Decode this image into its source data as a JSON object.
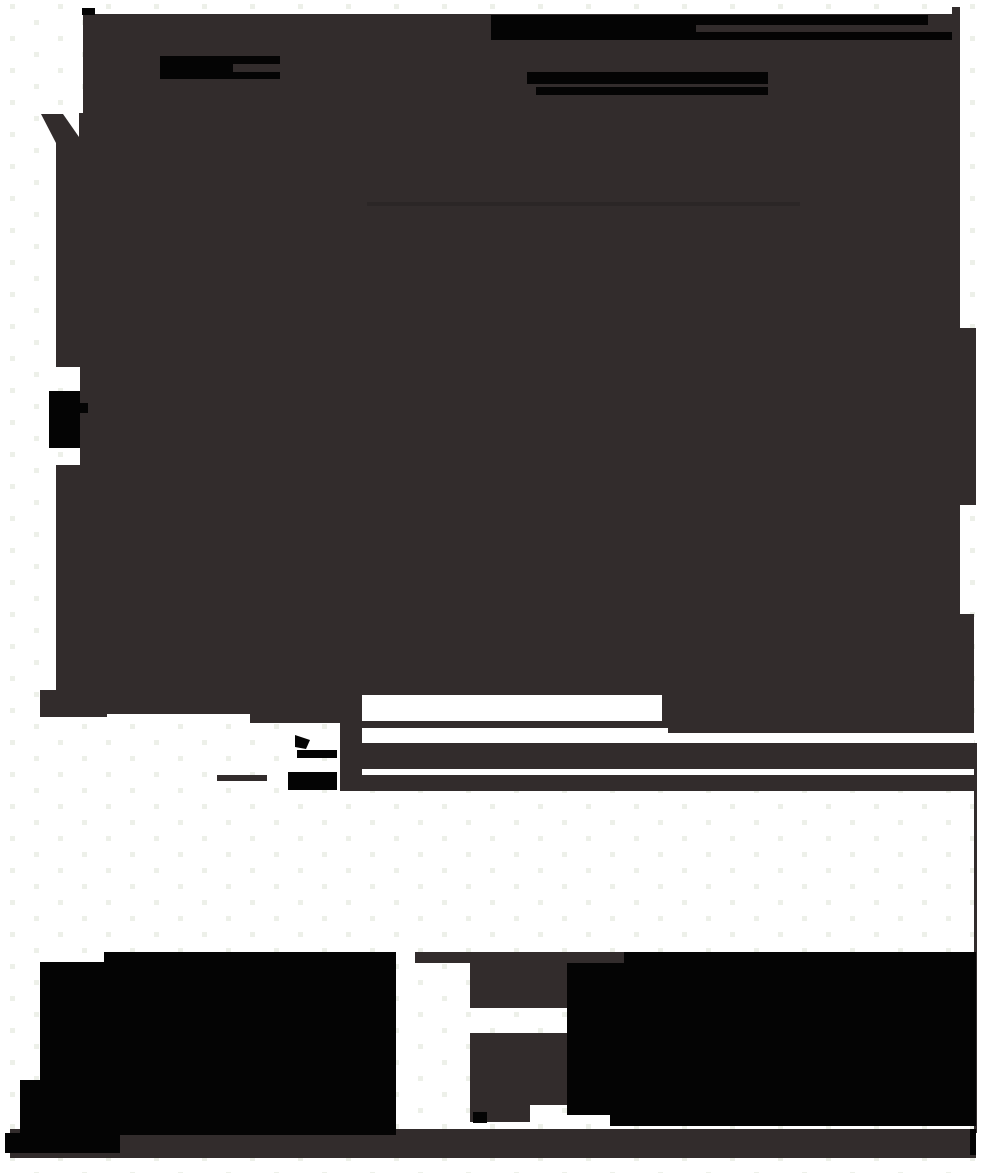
{
  "canvas": {
    "width": 982,
    "height": 1173,
    "description": "Mostly-flattened screenshot: large dark silhouette with solid black redaction bars and blobs over a white background patterned with faint pale dots. No readable text is visible anywhere in the image."
  },
  "colors": {
    "background": "#ffffff",
    "grid_dot": "#edf0e9",
    "silhouette": "#322c2c",
    "ink": "#040404",
    "faint_line": "#272222",
    "white": "#ffffff"
  },
  "shapes": {
    "main_silhouette": {
      "role": "large irregular dark mass covering most of upper canvas",
      "bbox": [
        40,
        7,
        936,
        784
      ]
    },
    "top_left_square": {
      "role": "small black square at top edge",
      "bbox": [
        82,
        8,
        13,
        7
      ]
    },
    "top_redaction_block": {
      "role": "solid black block left end of top bars",
      "bbox": [
        491,
        15,
        205,
        25
      ]
    },
    "top_redaction_bar_1": {
      "role": "black bar",
      "bbox": [
        491,
        15,
        437,
        10
      ]
    },
    "top_redaction_bar_2": {
      "role": "black bar",
      "bbox": [
        491,
        32,
        461,
        8
      ]
    },
    "left_redaction_bar": {
      "role": "black bar with gray notch",
      "bbox": [
        160,
        56,
        120,
        23
      ]
    },
    "mid_redaction_bar_1": {
      "role": "black bar",
      "bbox": [
        527,
        72,
        241,
        12
      ]
    },
    "mid_redaction_bar_2": {
      "role": "black bar",
      "bbox": [
        536,
        87,
        232,
        8
      ]
    },
    "left_edge_wedge": {
      "role": "dark wedge on left edge",
      "bbox": [
        41,
        114,
        38,
        29
      ]
    },
    "left_side_blob": {
      "role": "black blob notched into left edge",
      "bbox": [
        49,
        391,
        39,
        57
      ]
    },
    "faint_divider_line": {
      "role": "slightly darker horizontal line inside mass",
      "bbox": [
        367,
        202,
        433,
        4
      ]
    },
    "white_slot_1": {
      "role": "white rectangular cutout",
      "bbox": [
        362,
        695,
        300,
        26
      ]
    },
    "white_slot_2": {
      "role": "white rectangular cutout",
      "bbox": [
        362,
        728,
        306,
        12
      ]
    },
    "white_slot_3": {
      "role": "white strip cutout",
      "bbox": [
        668,
        733,
        306,
        10
      ]
    },
    "white_slot_4": {
      "role": "thin white strip",
      "bbox": [
        362,
        740,
        612,
        3
      ]
    },
    "white_slot_5": {
      "role": "thin white strip",
      "bbox": [
        362,
        769,
        612,
        6
      ]
    },
    "cursor_wedge": {
      "role": "small black pointer-like wedge",
      "bbox": [
        295,
        735,
        15,
        14
      ]
    },
    "cursor_bar": {
      "role": "small black bar",
      "bbox": [
        297,
        750,
        40,
        8
      ]
    },
    "icon_block": {
      "role": "small black block",
      "bbox": [
        288,
        772,
        49,
        18
      ]
    },
    "icon_line": {
      "role": "short gray line",
      "bbox": [
        217,
        775,
        50,
        6
      ]
    },
    "right_thin_line": {
      "role": "thin vertical gray line near right edge",
      "bbox": [
        974,
        743,
        3,
        390
      ]
    },
    "bottom_left_mass": {
      "role": "large solid black blob",
      "bbox": [
        20,
        952,
        376,
        183
      ]
    },
    "funnel_top": {
      "role": "gray T-shaped funnel cap",
      "bbox": [
        415,
        952,
        210,
        11
      ]
    },
    "funnel_stem": {
      "role": "gray funnel stem",
      "bbox": [
        470,
        963,
        97,
        45
      ]
    },
    "pedestal": {
      "role": "gray pedestal block",
      "bbox": [
        470,
        1033,
        97,
        72
      ]
    },
    "pedestal_foot": {
      "role": "gray pedestal foot",
      "bbox": [
        470,
        1105,
        60,
        17
      ]
    },
    "pedestal_marks": {
      "role": "tiny black marks on foot",
      "bbox": [
        473,
        1112,
        14,
        11
      ]
    },
    "bottom_right_mass": {
      "role": "large solid black block",
      "bbox": [
        567,
        952,
        409,
        174
      ]
    },
    "bottom_right_ledge": {
      "role": "gray ledge left of black block top",
      "bbox": [
        559,
        952,
        65,
        11
      ]
    },
    "bottom_band": {
      "role": "full-width gray band near bottom",
      "bbox": [
        10,
        1129,
        966,
        29
      ]
    },
    "band_left_cap": {
      "role": "black left end of bottom band",
      "bbox": [
        5,
        1133,
        115,
        20
      ]
    },
    "band_right_cap": {
      "role": "black right end of bottom band",
      "bbox": [
        970,
        1129,
        6,
        26
      ]
    }
  }
}
